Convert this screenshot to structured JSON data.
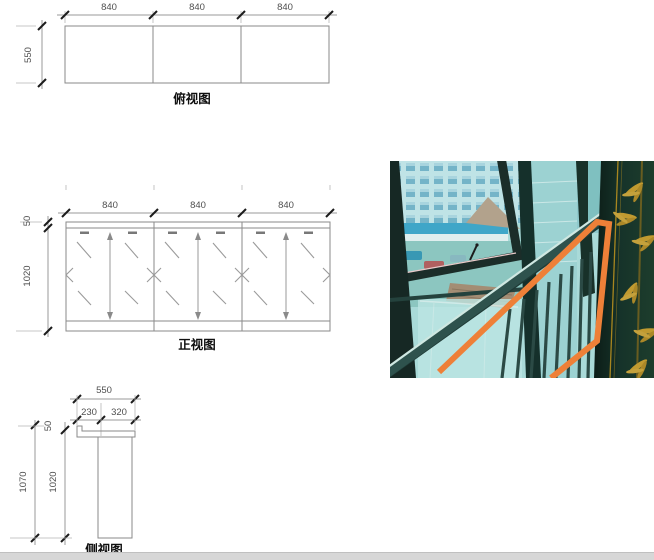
{
  "drawing": {
    "top_view": {
      "label": "俯视图",
      "width_dims": [
        "840",
        "840",
        "840"
      ],
      "depth_dim": "550"
    },
    "front_view": {
      "label": "正视图",
      "width_dims": [
        "840",
        "840",
        "840"
      ],
      "cap_dim": "50",
      "height_dim": "1020"
    },
    "side_view": {
      "label": "侧视图",
      "width_dim": "550",
      "front_offset_dim": "230",
      "back_offset_dim": "320",
      "cap_dim": "50",
      "overall_height_dim": "1070",
      "column_height_dim": "1020"
    }
  },
  "photo": {
    "highlight_color": "#ee8038"
  },
  "colors": {
    "drawing_line": "#8a8a8a",
    "tick_black": "#1c1c1c",
    "dim_text": "#4f4f4f",
    "photo_teal": "#a9dad8",
    "panel_green": "#16332a",
    "bamboo_gold": "#c09a30",
    "highlight_orange": "#ee8038",
    "scrollbar_gray": "#d7d7d7"
  }
}
